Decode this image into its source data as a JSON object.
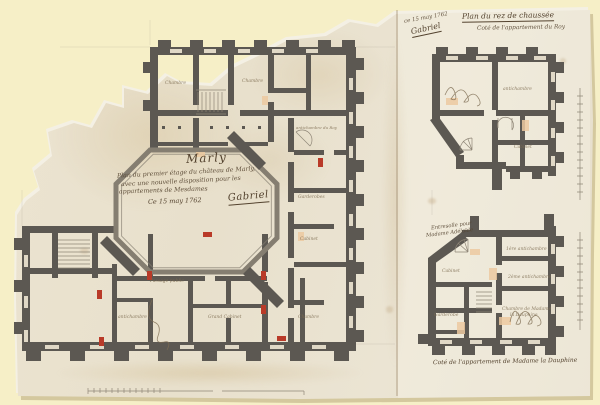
{
  "colors": {
    "mat": "#f6efc7",
    "paper": "#ebe3d0",
    "paper_edge": "#f4f0e4",
    "wall": "#5c5852",
    "wall_mid": "#857e71",
    "line": "#8f8677",
    "ink": "#53422e",
    "ink_faint": "#7d6c51",
    "red": "#b93a28",
    "fireplace": "#ecc9a0",
    "stain": "#d9c9a4"
  },
  "main_plan": {
    "title": "Marly",
    "subtitle_line1": "Plan du premier étage du château de Marly,",
    "subtitle_line2": "avec une nouvelle disposition pour les",
    "subtitle_line3": "appartements de Mesdames",
    "date_line": "Ce 15 may 1762",
    "signature": "Gabriel",
    "room_labels": [
      "Chambre",
      "Chambre",
      "antichambre du Roy",
      "Garderobes",
      "Cabinet",
      "Passage public",
      "antichambre",
      "Grand Cabinet",
      "Chambre"
    ]
  },
  "ground_plan": {
    "title": "Plan du rez de chaussée",
    "subtitle": "Coté de l'appartement du Roy",
    "date_note": "ce 15 may 1762",
    "signature": "Gabriel",
    "room_labels": [
      "antichambre",
      "Cabinet"
    ]
  },
  "dauphine_plan": {
    "note_line1": "Entresolle pour",
    "note_line2": "Madame Adélaïde",
    "caption": "Coté de l'appartement de Madame la Dauphine",
    "room_labels": [
      "1ère antichambre",
      "2ème antichambre",
      "Chambre de Madame",
      "la Dauphine",
      "Cabinet",
      "Garderobe"
    ]
  }
}
